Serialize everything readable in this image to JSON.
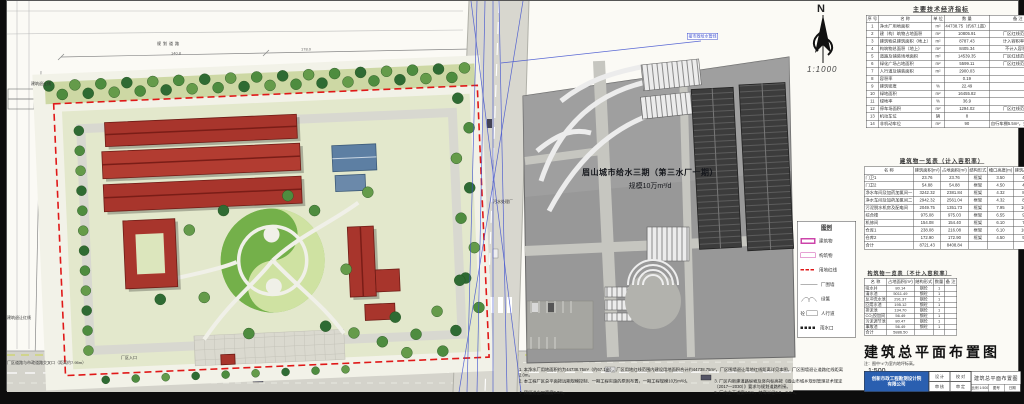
{
  "project_label": {
    "line1": "眉山城市给水三期（第三水厂一期）",
    "line2": "规模10万m³/d"
  },
  "north_arrow": {
    "letter": "N",
    "scale": "1:1000"
  },
  "indicators_table": {
    "title": "主要技术经济指标",
    "headers": [
      "序 号",
      "名  称",
      "单 位",
      "数 量",
      "备  注"
    ],
    "rows": [
      [
        "1",
        "净水厂用地面积",
        "m²",
        "44738.75（约67.1亩）",
        ""
      ],
      [
        "2",
        "建（构）筑物占地面积",
        "m²",
        "10805.91",
        "厂区红线范围内"
      ],
      [
        "3",
        "建筑物总建筑面积（地上）",
        "m²",
        "8787.43",
        "计入容积率部分"
      ],
      [
        "4",
        "构筑物总面积（地上）",
        "m²",
        "8405.34",
        "不计入容积率"
      ],
      [
        "5",
        "道路及铺装场地面积",
        "m²",
        "14539.35",
        "厂区红线范围内"
      ],
      [
        "6",
        "绿化广场占地面积",
        "m²",
        "5599.11",
        "厂区红线范围内"
      ],
      [
        "7",
        "人行道及铺装面积",
        "m²",
        "2900.03",
        ""
      ],
      [
        "8",
        "容积率",
        "",
        "0.19",
        ""
      ],
      [
        "9",
        "建筑密度",
        "%",
        "22.49",
        ""
      ],
      [
        "10",
        "绿地面积",
        "m²",
        "16455.82",
        ""
      ],
      [
        "11",
        "绿地率",
        "%",
        "36.9",
        ""
      ],
      [
        "12",
        "停车场面积",
        "m²",
        "1294.02",
        "厂区红线范围内"
      ],
      [
        "13",
        "机动车位",
        "辆",
        "8",
        ""
      ],
      [
        "14",
        "非机动车位",
        "m²",
        "90",
        "自行车棚5.5m²，共14个车位"
      ]
    ]
  },
  "buildings_table": {
    "title": "建筑物一览表（计入容积率）",
    "headers": [
      "名  称",
      "建筑面积(m²)",
      "占地面积(m²)",
      "结构形式",
      "檐口高度(m)",
      "建筑高度(m)",
      "数量",
      "备 注"
    ],
    "rows": [
      [
        "门卫1",
        "23.76",
        "23.76",
        "框架",
        "3.50",
        "4.95",
        "1",
        ""
      ],
      [
        "门卫2",
        "54.88",
        "54.88",
        "框架",
        "4.50",
        "4.82",
        "1",
        ""
      ],
      [
        "净水车间及加药加氯间一",
        "3242.32",
        "2381.84",
        "框架",
        "4.32",
        "8.29",
        "1",
        ""
      ],
      [
        "净水车间及加药加氯间二",
        "2942.32",
        "2561.04",
        "框架",
        "4.32",
        "8.29",
        "1",
        ""
      ],
      [
        "污泥脱水机房及配电间",
        "2049.75",
        "1351.73",
        "框架",
        "7.95",
        "10.10",
        "1",
        ""
      ],
      [
        "综合楼",
        "975.08",
        "975.03",
        "框架",
        "6.55",
        "9.40",
        "1",
        ""
      ],
      [
        "机修间",
        "154.08",
        "154.40",
        "框架",
        "6.10",
        "7.76",
        "1",
        ""
      ],
      [
        "仓库1",
        "238.08",
        "216.08",
        "框架",
        "6.10",
        "10.76",
        "1",
        ""
      ],
      [
        "仓库2",
        "172.90",
        "172.90",
        "框架",
        "4.50",
        "9.46",
        "1",
        ""
      ],
      [
        "合计",
        "8721.43",
        "8408.84",
        "",
        "",
        "",
        "",
        ""
      ]
    ]
  },
  "structures_table": {
    "title": "构筑物一览表（不计入容积率）",
    "headers": [
      "名  称",
      "占地面积(m²)",
      "结构形式",
      "数量",
      "备 注"
    ],
    "rows": [
      [
        "吸水井",
        "80.14",
        "钢砼",
        "1",
        ""
      ],
      [
        "清水池",
        "5011.49",
        "钢砼",
        "1",
        ""
      ],
      [
        "反冲洗水池",
        "291.37",
        "钢砼",
        "1",
        ""
      ],
      [
        "回用水池",
        "195.12",
        "钢砼",
        "1",
        ""
      ],
      [
        "排泥池",
        "134.70",
        "钢砼",
        "1",
        ""
      ],
      [
        "CO₂投加间",
        "56.49",
        "钢砼",
        "1",
        ""
      ],
      [
        "污泥调节池",
        "80.47",
        "钢砼",
        "1",
        ""
      ],
      [
        "事故池",
        "56.49",
        "钢砼",
        "1",
        ""
      ],
      [
        "合计",
        "5886.50",
        "",
        "",
        ""
      ]
    ]
  },
  "legend": {
    "title": "图例",
    "items": [
      {
        "symbol": "building",
        "label": "建筑物"
      },
      {
        "symbol": "structure",
        "label": "构筑物"
      },
      {
        "symbol": "red-dash",
        "label": "用地红线"
      },
      {
        "symbol": "wall",
        "label": "厂围墙"
      },
      {
        "symbol": "hedge",
        "label": "绿篱"
      },
      {
        "symbol": "pavement",
        "label": "人行道"
      },
      {
        "symbol": "black-dash",
        "label": "雨水口"
      }
    ]
  },
  "drawing_title": {
    "text": "建筑总平面布置图",
    "scale": "1:500",
    "note": "注：图中“±”为室内地坪标高。"
  },
  "notes": {
    "n1": "1. 本净水厂用地面积约为44738.75m²（约67.1亩），厂区用地红线范围内建设用地面积合计约44738.75m²，厂区围墙退让用地红线距离详见本图，厂区围墙退让道路红线距离2.0m。",
    "n2": "2. 本工程厂区总平面按远期规模控制、一期工程实施的原则布置，一期工程规模10万m³/d。",
    "n3": "3. 厂区内新建道路纵坡及竖向标高按《眉山市城乡规划管理技术规定（2017—2030）》要求与规划道路衔接。",
    "n4": "4. 预留进出口宽度9.0m。",
    "n5": "5. 厂内主干道宽4.5m，转弯半径6.0—9.0m。"
  },
  "title_block": {
    "company_line1": "创新市政工程勘测设计院",
    "company_line2": "有限公司",
    "design_label": "设 计",
    "check_label": "校 对",
    "review_label": "审 核",
    "approve_label": "审 定",
    "drawing_name": "建筑总平面布置图",
    "scale_cell": "比例 1:500",
    "no_cell": "图号",
    "date_cell": "日期"
  },
  "site_labels": {
    "planned_road_top": "规划道路",
    "entrance": "厂区入口",
    "crossing_note": "厂区道路与市政道路交叉口（距离约7.95m）",
    "setback_line": "建筑退让线",
    "setback_red_line": "建筑退让红线",
    "sewage_plant": "污水处理厂",
    "pipeline": "接市政给水管线",
    "dim1": "140.8",
    "dim2": "178.0"
  },
  "colors": {
    "boundary_red": "#e01818",
    "roof_red": "#a8352c",
    "roof_blue": "#5d7fa3",
    "tree_green": "#3f7a38",
    "survey_blue": "#3c4ecf",
    "legend_magenta": "#cc44aa",
    "company_blue": "#2a5fb0"
  }
}
